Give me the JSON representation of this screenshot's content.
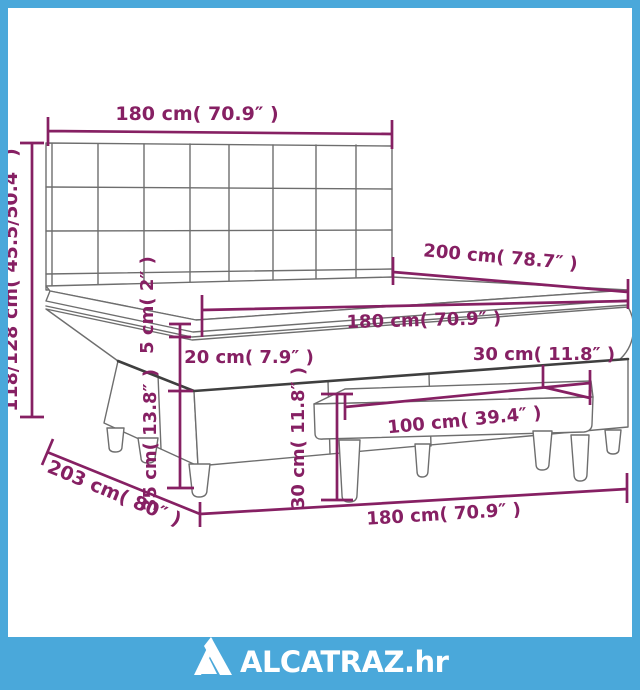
{
  "diagram": {
    "title_hint": "box spring bed with headboard and bench dimension drawing",
    "dims": {
      "headboard_width": "180 cm( 70.9″ )",
      "total_height": "118/128 cm( 45.5/50.4″ )",
      "bed_length": "200 cm( 78.7″ )",
      "mattress_width": "180 cm( 70.9″ )",
      "topper_height": "5 cm( 2″ )",
      "mattress_height": "20 cm( 7.9″ )",
      "bench_depth": "30 cm( 11.8″ )",
      "bench_height": "30 cm( 11.8″ )",
      "bench_length": "100 cm( 39.4″ )",
      "base_height": "35 cm( 13.8″ )",
      "total_length": "203 cm( 80″ )",
      "bed_width": "180 cm( 70.9″ )"
    },
    "colors": {
      "dimension": "#862063",
      "drawing_line": "#6e6e6e",
      "frame_blue": "#4AA8DA"
    }
  },
  "footer": {
    "brand": "ALCATRAZ.hr"
  }
}
